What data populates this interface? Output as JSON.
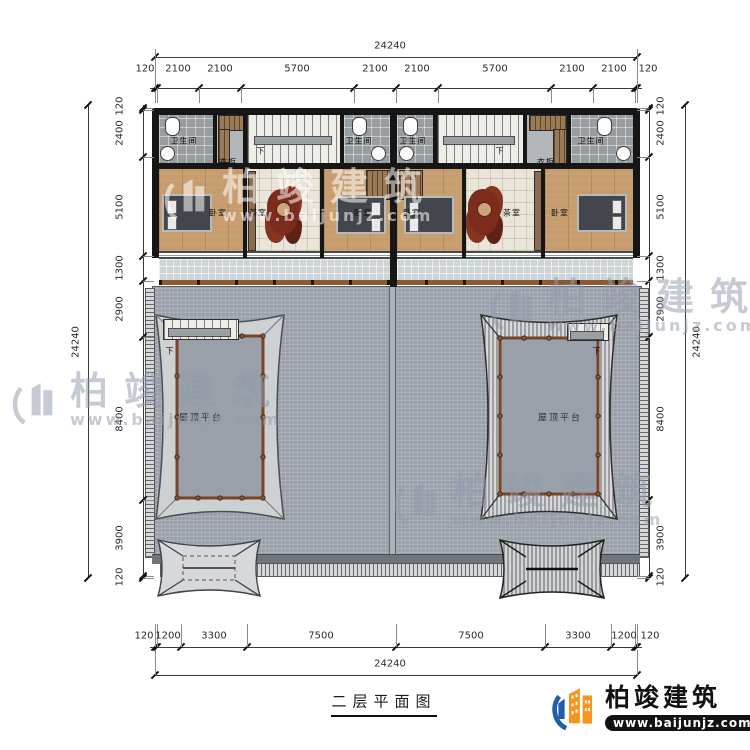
{
  "title": {
    "text": "二层平面图"
  },
  "branding": {
    "name": "柏竣建筑",
    "url": "www.baijunjz.com"
  },
  "watermark": {
    "name": "柏竣建筑",
    "url": "www.baijunjz.com"
  },
  "labels": {
    "bathroom": "卫生间",
    "wardrobe": "衣柜",
    "bedroom": "卧室",
    "tearoom": "茶室",
    "roof_terrace": "屋顶平台",
    "down": "下"
  },
  "dimensions": {
    "top": {
      "overall": "24240",
      "segments": [
        "120",
        "2100",
        "2100",
        "5700",
        "2100",
        "2100",
        "5700",
        "2100",
        "2100",
        "120"
      ]
    },
    "bottom": {
      "overall": "24240",
      "segments": [
        "120",
        "1200",
        "3300",
        "7500",
        "7500",
        "3300",
        "1200",
        "120"
      ]
    },
    "left": {
      "overall": "24240",
      "segments": [
        "120",
        "2400",
        "5100",
        "1300",
        "2900",
        "8400",
        "3900",
        "120"
      ]
    },
    "right": {
      "overall": "24240",
      "segments": [
        "120",
        "2400",
        "5100",
        "1300",
        "2900",
        "8400",
        "3900",
        "120"
      ]
    }
  },
  "colors": {
    "wall": "#161616",
    "terrace_gray": "#9aa0a9",
    "wood_floor": "#c79d6d",
    "railing_brown": "#8a5a33",
    "brand_orange": "#f7941e",
    "brand_blue": "#1f5fa8"
  }
}
